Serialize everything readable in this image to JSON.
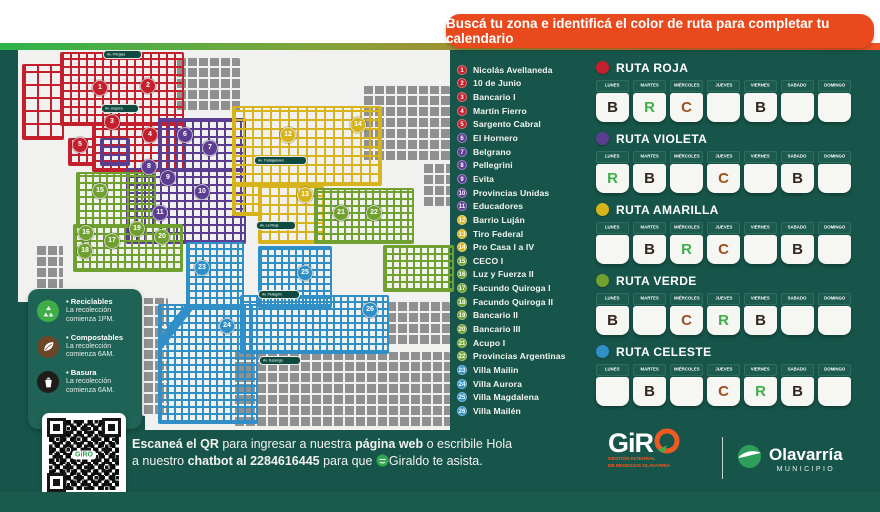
{
  "banner": {
    "text": "Buscá tu zona e identificá el color de ruta para completar tu calendario"
  },
  "colors": {
    "background": "#17554a",
    "banner": "#e84a1d",
    "roja": "#c41f2d",
    "violeta": "#5b3d91",
    "amarilla": "#d7b31c",
    "verde": "#6fa030",
    "celeste": "#2f8fc6",
    "letter_R": "#3fae49",
    "letter_C": "#9c501d",
    "letter_B": "#33261e"
  },
  "zones": [
    {
      "num": 1,
      "name": "Nicolás Avellaneda",
      "route": "roja"
    },
    {
      "num": 2,
      "name": "10 de Junio",
      "route": "roja"
    },
    {
      "num": 3,
      "name": "Bancario I",
      "route": "roja"
    },
    {
      "num": 4,
      "name": "Martín Fierro",
      "route": "roja"
    },
    {
      "num": 5,
      "name": "Sargento Cabral",
      "route": "roja"
    },
    {
      "num": 6,
      "name": "El Hornero",
      "route": "violeta"
    },
    {
      "num": 7,
      "name": "Belgrano",
      "route": "violeta"
    },
    {
      "num": 8,
      "name": "Pellegrini",
      "route": "violeta"
    },
    {
      "num": 9,
      "name": "Evita",
      "route": "violeta"
    },
    {
      "num": 10,
      "name": "Provincias Unidas",
      "route": "violeta"
    },
    {
      "num": 11,
      "name": "Educadores",
      "route": "violeta"
    },
    {
      "num": 12,
      "name": "Barrio Luján",
      "route": "amarilla"
    },
    {
      "num": 13,
      "name": "Tiro Federal",
      "route": "amarilla"
    },
    {
      "num": 14,
      "name": "Pro Casa I a IV",
      "route": "amarilla"
    },
    {
      "num": 15,
      "name": "CECO I",
      "route": "verde"
    },
    {
      "num": 16,
      "name": "Luz y Fuerza II",
      "route": "verde"
    },
    {
      "num": 17,
      "name": "Facundo Quiroga I",
      "route": "verde"
    },
    {
      "num": 18,
      "name": "Facundo Quiroga II",
      "route": "verde"
    },
    {
      "num": 19,
      "name": "Bancario II",
      "route": "verde"
    },
    {
      "num": 20,
      "name": "Bancario III",
      "route": "verde"
    },
    {
      "num": 21,
      "name": "Acupo I",
      "route": "verde"
    },
    {
      "num": 22,
      "name": "Provincias Argentinas",
      "route": "verde"
    },
    {
      "num": 23,
      "name": "Villa Mailin",
      "route": "celeste"
    },
    {
      "num": 24,
      "name": "Villa Aurora",
      "route": "celeste"
    },
    {
      "num": 25,
      "name": "Villa Magdalena",
      "route": "celeste"
    },
    {
      "num": 26,
      "name": "Villa Mailén",
      "route": "celeste"
    }
  ],
  "day_headers": [
    "LUNES",
    "MARTES",
    "MIÉRCOLES",
    "JUEVES",
    "VIERNES",
    "SÁBADO",
    "DOMINGO"
  ],
  "routes": [
    {
      "name": "RUTA ROJA",
      "route": "roja",
      "days": [
        "B",
        "R",
        "C",
        "",
        "B",
        "",
        ""
      ]
    },
    {
      "name": "RUTA VIOLETA",
      "route": "violeta",
      "days": [
        "R",
        "B",
        "",
        "C",
        "",
        "B",
        ""
      ]
    },
    {
      "name": "RUTA AMARILLA",
      "route": "amarilla",
      "days": [
        "",
        "B",
        "R",
        "C",
        "",
        "B",
        ""
      ]
    },
    {
      "name": "RUTA VERDE",
      "route": "verde",
      "days": [
        "B",
        "",
        "C",
        "R",
        "B",
        "",
        ""
      ]
    },
    {
      "name": "RUTA CELESTE",
      "route": "celeste",
      "days": [
        "",
        "B",
        "",
        "C",
        "R",
        "B",
        ""
      ]
    }
  ],
  "waste_legend": [
    {
      "title": "• Reciclables",
      "desc": "La recolección comienza 1PM.",
      "icon": "recycle-icon",
      "color": "#3fae49"
    },
    {
      "title": "• Compostables",
      "desc": "La recolección comienza 6AM.",
      "icon": "leaf-icon",
      "color": "#6d4527"
    },
    {
      "title": "• Basura",
      "desc": "La recolección comienza 6AM.",
      "icon": "trash-bag-icon",
      "color": "#201c19"
    }
  ],
  "map": {
    "badges": [
      {
        "n": 1,
        "x": 82,
        "y": 38,
        "route": "roja"
      },
      {
        "n": 2,
        "x": 130,
        "y": 36,
        "route": "roja"
      },
      {
        "n": 3,
        "x": 94,
        "y": 72,
        "route": "roja"
      },
      {
        "n": 4,
        "x": 132,
        "y": 85,
        "route": "roja"
      },
      {
        "n": 5,
        "x": 62,
        "y": 95,
        "route": "roja"
      },
      {
        "n": 6,
        "x": 167,
        "y": 85,
        "route": "violeta"
      },
      {
        "n": 7,
        "x": 192,
        "y": 98,
        "route": "violeta"
      },
      {
        "n": 8,
        "x": 131,
        "y": 117,
        "route": "violeta"
      },
      {
        "n": 9,
        "x": 150,
        "y": 128,
        "route": "violeta"
      },
      {
        "n": 10,
        "x": 184,
        "y": 142,
        "route": "violeta"
      },
      {
        "n": 11,
        "x": 142,
        "y": 163,
        "route": "violeta"
      },
      {
        "n": 12,
        "x": 270,
        "y": 85,
        "route": "amarilla"
      },
      {
        "n": 13,
        "x": 287,
        "y": 145,
        "route": "amarilla"
      },
      {
        "n": 14,
        "x": 340,
        "y": 75,
        "route": "amarilla"
      },
      {
        "n": 15,
        "x": 82,
        "y": 141,
        "route": "verde"
      },
      {
        "n": 16,
        "x": 68,
        "y": 183,
        "route": "verde"
      },
      {
        "n": 17,
        "x": 94,
        "y": 191,
        "route": "verde"
      },
      {
        "n": 18,
        "x": 67,
        "y": 201,
        "route": "verde"
      },
      {
        "n": 19,
        "x": 119,
        "y": 179,
        "route": "verde"
      },
      {
        "n": 20,
        "x": 144,
        "y": 187,
        "route": "verde"
      },
      {
        "n": 21,
        "x": 323,
        "y": 163,
        "route": "verde"
      },
      {
        "n": 22,
        "x": 356,
        "y": 163,
        "route": "verde"
      },
      {
        "n": 23,
        "x": 184,
        "y": 218,
        "route": "celeste"
      },
      {
        "n": 24,
        "x": 209,
        "y": 276,
        "route": "celeste"
      },
      {
        "n": 25,
        "x": 287,
        "y": 223,
        "route": "celeste"
      },
      {
        "n": 26,
        "x": 352,
        "y": 260,
        "route": "celeste"
      }
    ],
    "street_labels": [
      {
        "text": "Av. Pringles",
        "x": 87,
        "y": 0
      },
      {
        "text": "Av. Urquiza",
        "x": 85,
        "y": 54
      },
      {
        "text": "Av. Trabajadores",
        "x": 238,
        "y": 106
      },
      {
        "text": "Av. La Rioja",
        "x": 240,
        "y": 171
      },
      {
        "text": "Av. Pellegrini",
        "x": 242,
        "y": 240
      },
      {
        "text": "Av. Ituzaingó",
        "x": 243,
        "y": 306
      }
    ]
  },
  "footer": {
    "line1": [
      {
        "t": "Escaneá el QR",
        "b": true
      },
      {
        "t": " para ingresar a nuestra ",
        "b": false
      },
      {
        "t": "página web",
        "b": true
      },
      {
        "t": " o escribile Hola",
        "b": false
      }
    ],
    "line2": [
      {
        "t": "a nuestro ",
        "b": false
      },
      {
        "t": "chatbot al 2284616445",
        "b": true
      },
      {
        "t": " para que ",
        "b": false
      },
      {
        "t": "",
        "icon": "chatbot-icon"
      },
      {
        "t": "Giraldo te asista.",
        "b": false
      }
    ],
    "qr_center": "GiRO"
  },
  "logos": {
    "giro": {
      "word": "GiR",
      "tagline1": "GESTIÓN INTEGRAL",
      "tagline2": "DE RESIDUOS OLAVARRÍA"
    },
    "olavarria": {
      "name": "Olavarría",
      "sub": "MUNICIPIO"
    }
  }
}
